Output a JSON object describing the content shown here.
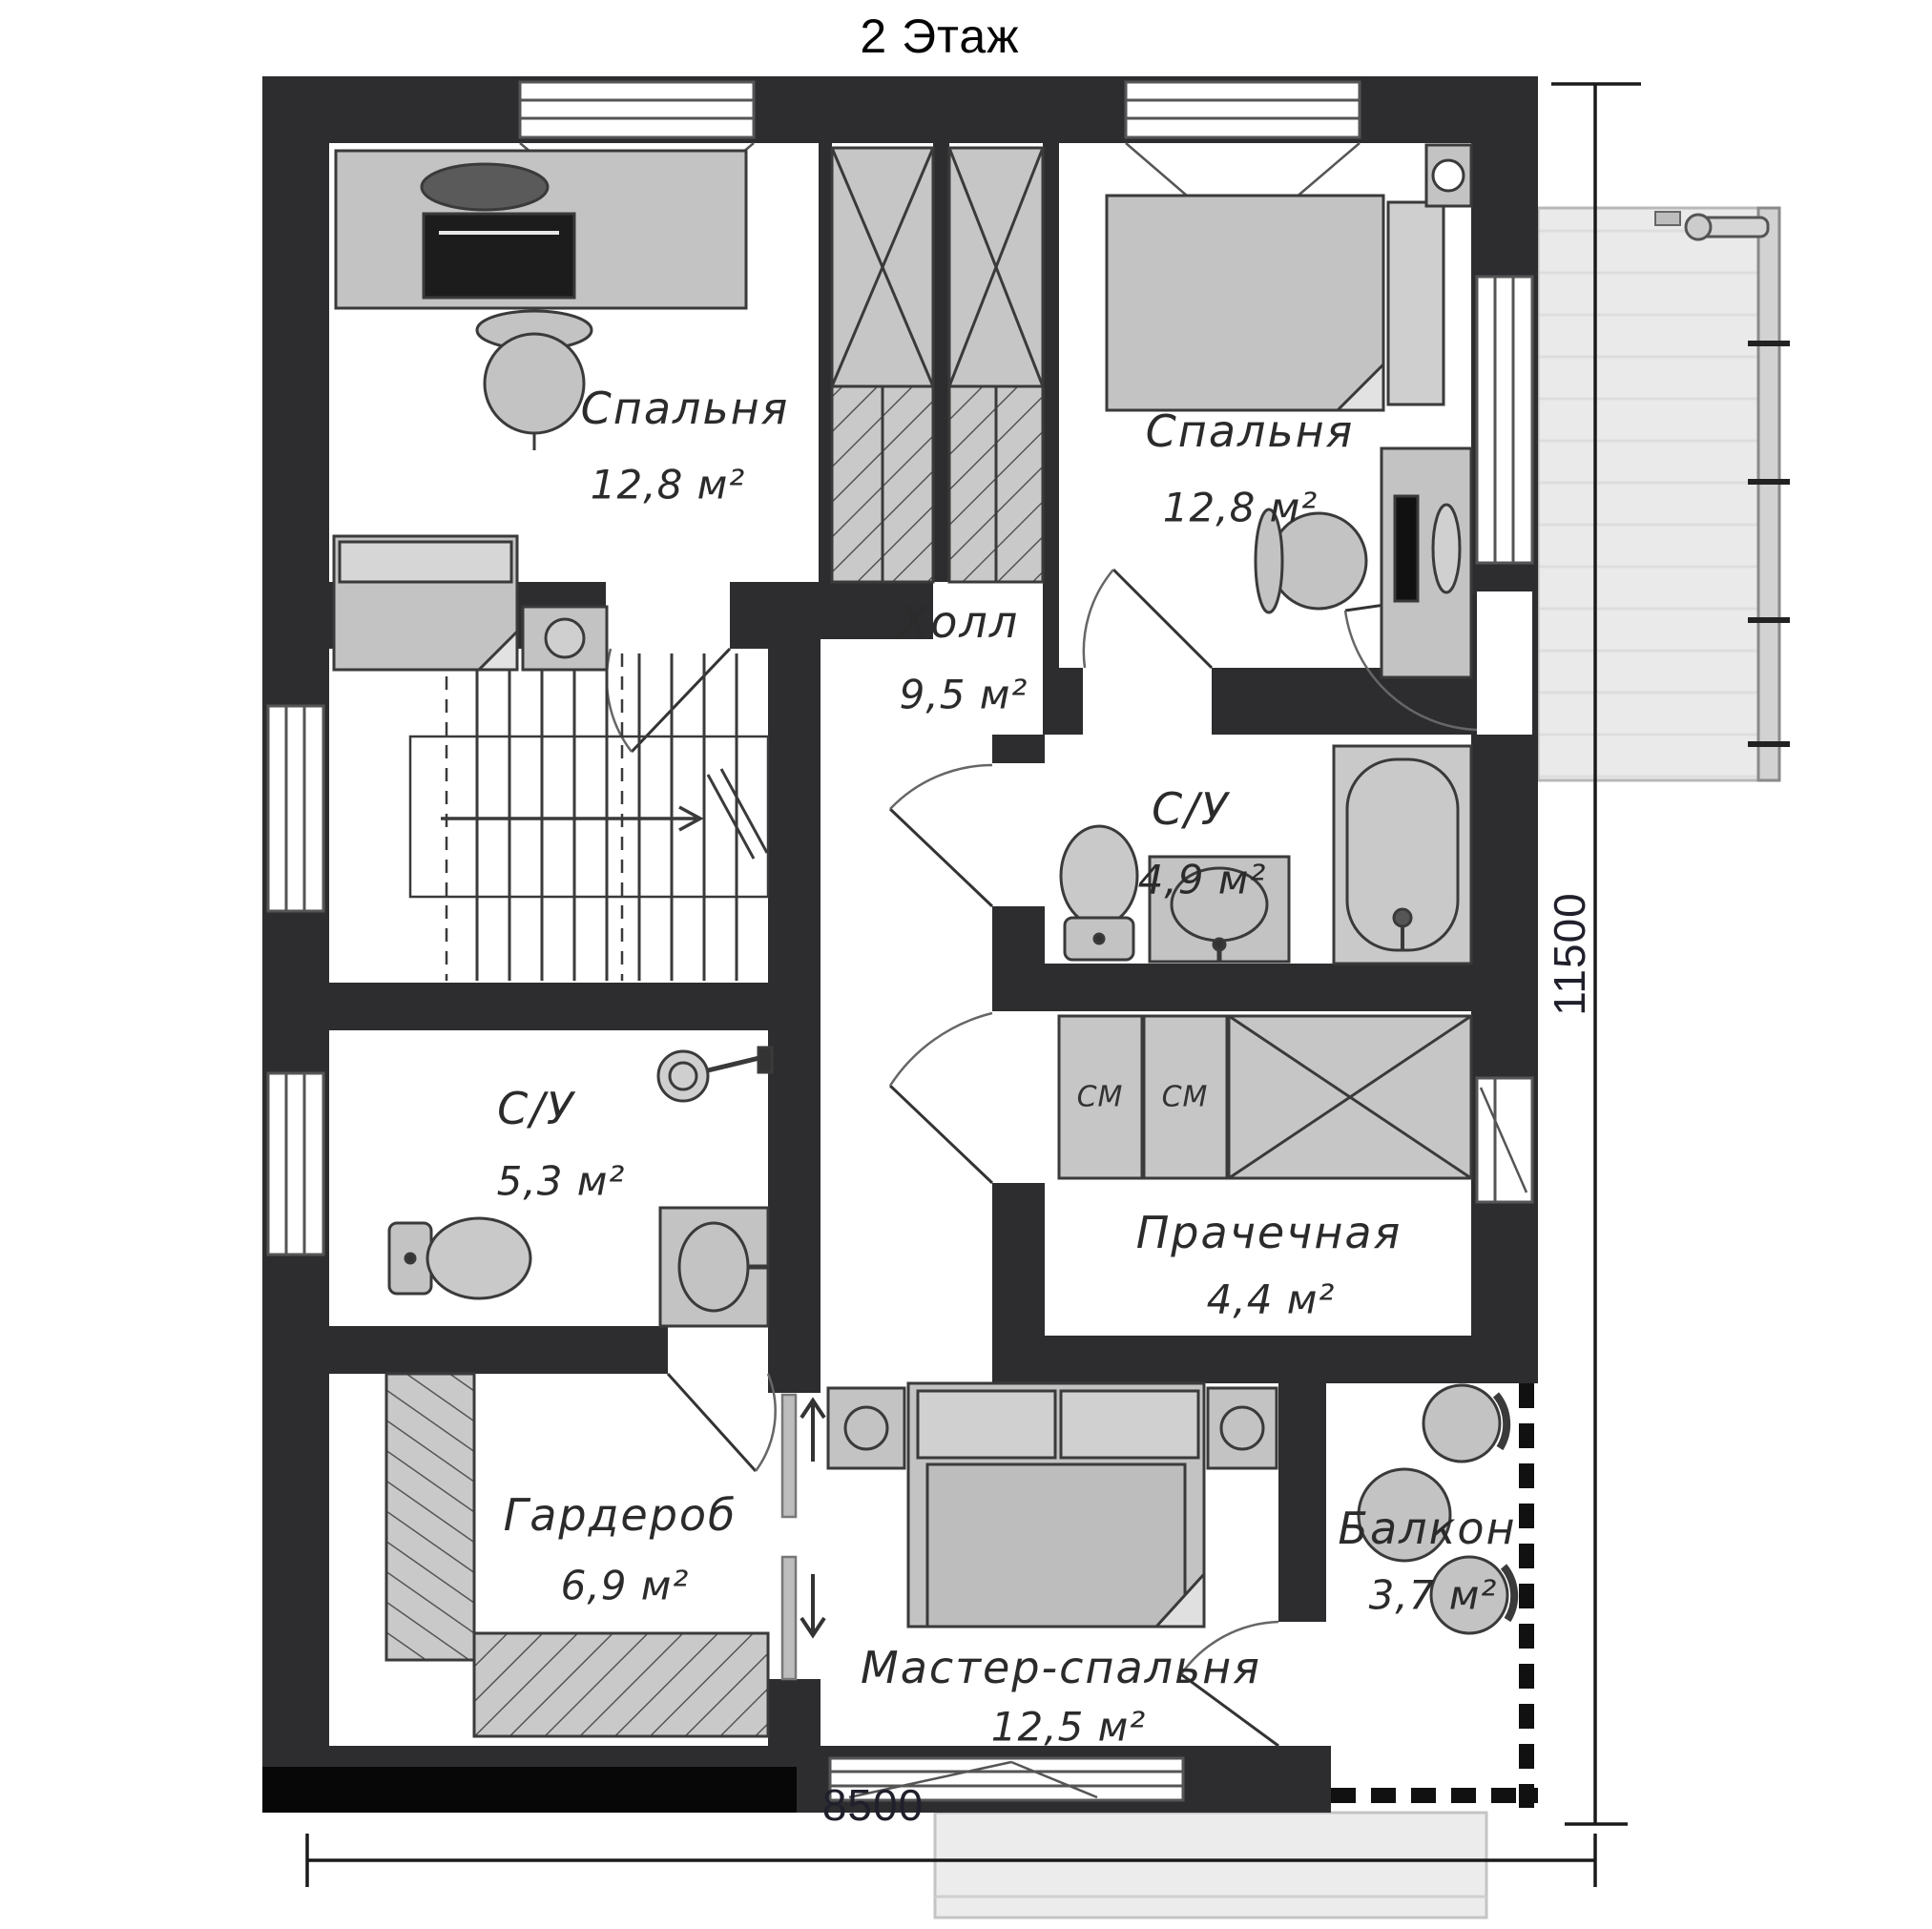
{
  "title": "2 Этаж",
  "rooms": [
    {
      "id": "bedroom-1",
      "name": "Спальня",
      "area": "12,8 м²"
    },
    {
      "id": "bedroom-2",
      "name": "Спальня",
      "area": "12,8 м²"
    },
    {
      "id": "hall",
      "name": "Холл",
      "area": "9,5 м²"
    },
    {
      "id": "bathroom-1",
      "name": "С/У",
      "area": "4,9 м²"
    },
    {
      "id": "laundry",
      "name": "Прачечная",
      "area": "4,4 м²"
    },
    {
      "id": "bathroom-2",
      "name": "С/У",
      "area": "5,3 м²"
    },
    {
      "id": "wardrobe",
      "name": "Гардероб",
      "area": "6,9 м²"
    },
    {
      "id": "master-bedroom",
      "name": "Мастер-спальня",
      "area": "12,5 м²"
    },
    {
      "id": "balcony",
      "name": "Балкон",
      "area": "3,7 м²"
    }
  ],
  "appliances": {
    "washer_1": "СМ",
    "washer_2": "СМ"
  },
  "dimensions": {
    "width_mm": "8500",
    "height_mm": "11500"
  },
  "colors": {
    "wall": "#2d2d30",
    "wall_black_band": "#070707",
    "furniture_fill": "#c3c3c3",
    "furniture_dark": "#1c1c1c",
    "terrace_fill": "#eaeaea",
    "room_fill": "#ffffff",
    "label_text": "#2b2b2b",
    "dimension_text": "#20202c"
  },
  "icons": {
    "stairs_direction": "arrow-right",
    "pocket_door_up": "arrow-up",
    "pocket_door_down": "arrow-down"
  }
}
